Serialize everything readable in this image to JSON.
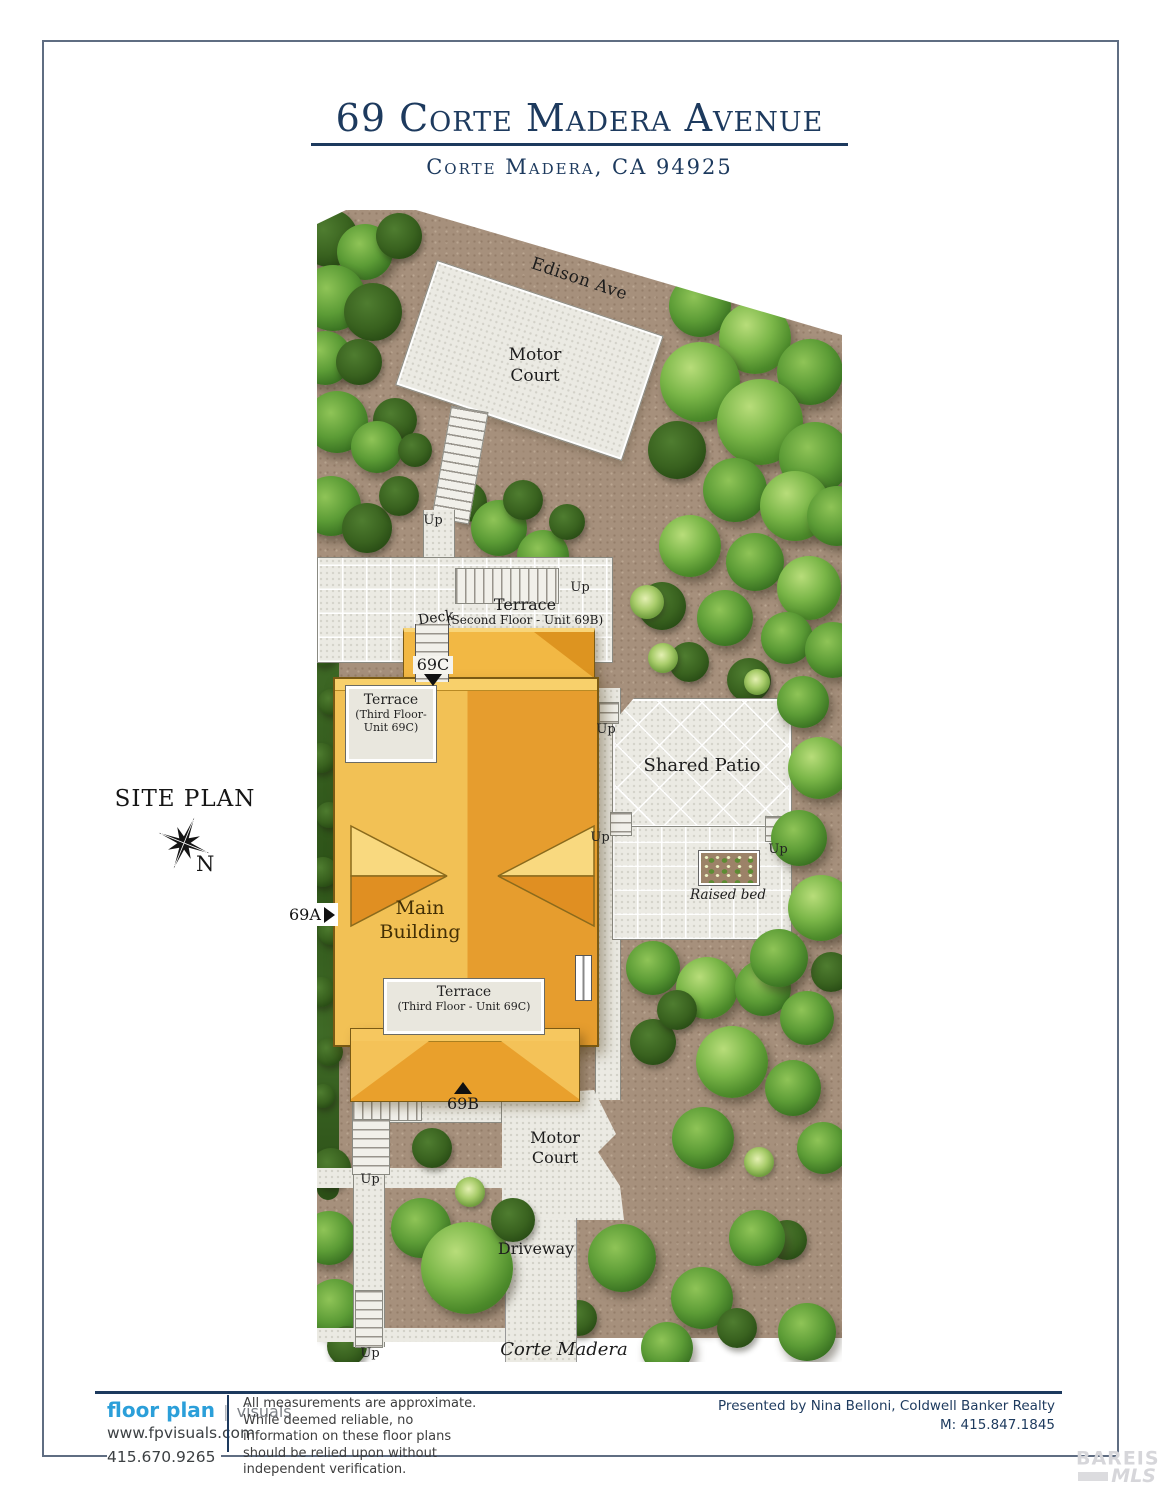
{
  "header": {
    "title": "69 Corte Madera Avenue",
    "subtitle": "Corte Madera, CA 94925"
  },
  "plan": {
    "heading": "SITE PLAN",
    "compass_n": "N",
    "labels": {
      "edison_ave": "Edison Ave",
      "motor_court": "Motor Court",
      "up": "Up",
      "deck": "Deck",
      "terrace": "Terrace",
      "terrace_2f_sub": "(Second Floor - Unit 69B)",
      "terrace_3f_sub1": "(Third Floor-",
      "terrace_3f_sub2": "Unit 69C)",
      "terrace_3f_sub_b": "(Third Floor - Unit 69C)",
      "shared_patio": "Shared Patio",
      "raised_bed": "Raised bed",
      "main_building": "Main Building",
      "marker_69a": "69A",
      "marker_69b": "69B",
      "marker_69c": "69C",
      "driveway": "Driveway",
      "corte_madera_ave": "Corte Madera Ave"
    }
  },
  "footer": {
    "brand_primary": "floor plan",
    "brand_separator": "|",
    "brand_secondary": "visuals",
    "website": "www.fpvisuals.com",
    "phone": "415.670.9265",
    "disclaimer": "All measurements are approximate. While deemed reliable, no information on these floor plans should be relied upon without independent verification.",
    "presented_by": "Presented by Nina Belloni, Coldwell Banker Realty",
    "mobile": "M: 415.847.1845"
  },
  "watermark": {
    "line1": "BAREIS",
    "reg": "®",
    "line2": "MLS"
  },
  "colors": {
    "navy": "#1d3a5e",
    "brand_blue": "#2b9fd9",
    "building_light": "#f2c155",
    "building_dark": "#e69d2e",
    "ground_brown": "#a6907c",
    "paved": "#ebeae3",
    "tree_green": "#5c9c36"
  }
}
